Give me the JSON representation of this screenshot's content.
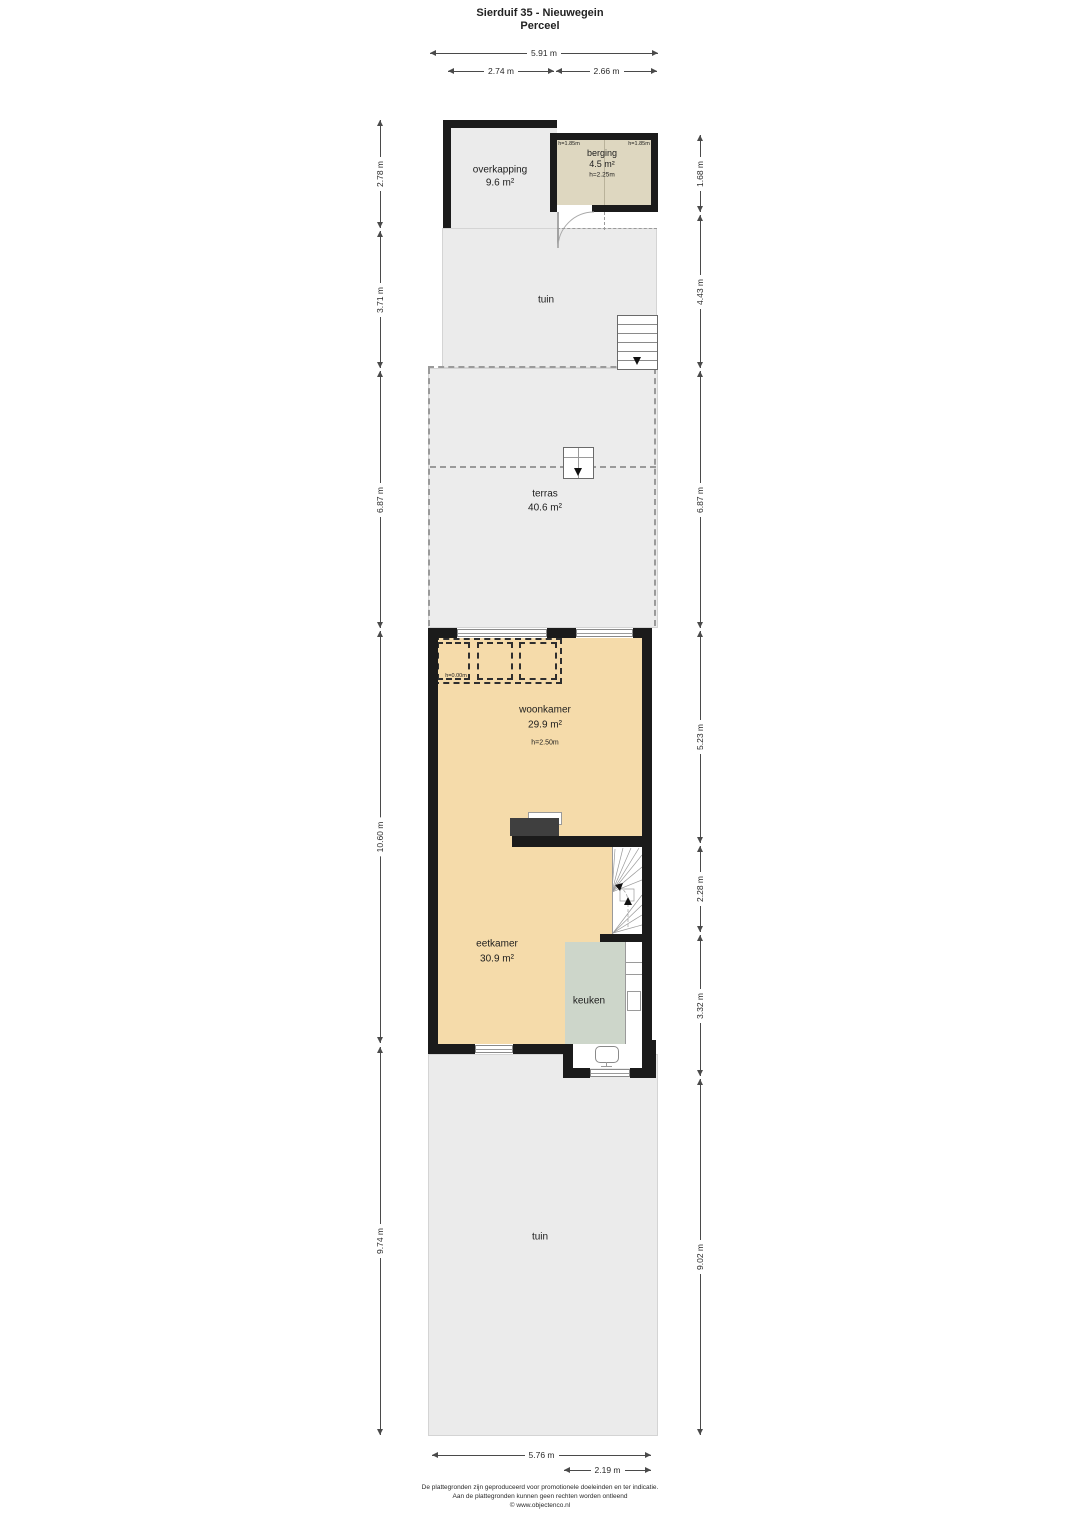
{
  "title": {
    "line1": "Sierduif 35 - Nieuwegein",
    "line2": "Perceel"
  },
  "rooms": {
    "overkapping": {
      "name": "overkapping",
      "area": "9.6 m²"
    },
    "berging": {
      "name": "berging",
      "area": "4.5 m²",
      "height": "h=2.25m",
      "height_left": "h=1.85m",
      "height_right": "h=1.85m"
    },
    "tuin_top": {
      "name": "tuin"
    },
    "terras": {
      "name": "terras",
      "area": "40.6 m²"
    },
    "woonkamer": {
      "name": "woonkamer",
      "area": "29.9 m²",
      "height": "h=2.50m",
      "void_label": "h=0.00m"
    },
    "eetkamer": {
      "name": "eetkamer",
      "area": "30.9 m²"
    },
    "keuken": {
      "name": "keuken"
    },
    "tuin_bottom": {
      "name": "tuin"
    }
  },
  "dimensions": {
    "top": [
      {
        "label": "5.91 m"
      },
      {
        "label": "2.74 m"
      },
      {
        "label": "2.66 m"
      }
    ],
    "left": [
      {
        "label": "2.78 m"
      },
      {
        "label": "3.71 m"
      },
      {
        "label": "6.87 m"
      },
      {
        "label": "10.60 m"
      },
      {
        "label": "9.74 m"
      }
    ],
    "right": [
      {
        "label": "1.68 m"
      },
      {
        "label": "4.43 m"
      },
      {
        "label": "6.87 m"
      },
      {
        "label": "5.23 m"
      },
      {
        "label": "2.28 m"
      },
      {
        "label": "3.32 m"
      },
      {
        "label": "9.02 m"
      }
    ],
    "bottom": [
      {
        "label": "5.76 m"
      },
      {
        "label": "2.19 m"
      }
    ]
  },
  "footer": {
    "line1": "De plattegronden zijn geproduceerd voor promotionele doeleinden en ter indicatie.",
    "line2": "Aan de plattegronden kunnen geen rechten worden ontleend",
    "line3": "© www.objectenco.nl"
  },
  "colors": {
    "wall": "#1b1b1b",
    "floor_living": "#f5dbaa",
    "floor_kitchen": "#cdd6ca",
    "floor_storage": "#ded7c0",
    "outdoor": "#ebebeb",
    "closet": "#3f3f3f"
  }
}
